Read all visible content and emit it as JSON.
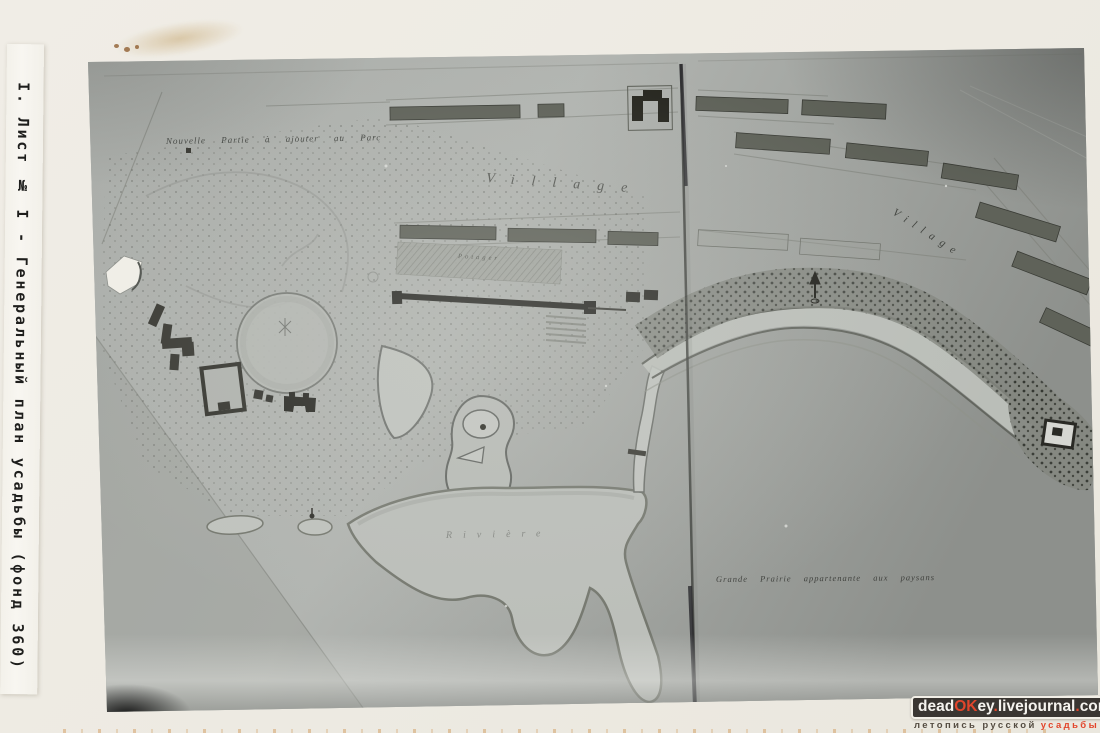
{
  "page": {
    "description": "Archival album page with a black-and-white photograph of an estate general plan",
    "paper_color": "#edeae2",
    "accent_red": "#e2452b"
  },
  "side_label": {
    "text": "I. Лист № I - Генеральный план усадьбы (фонд 360)"
  },
  "photo": {
    "map_labels": {
      "nouvelle_partie": "Nouvelle Partie à ajouter au Parc",
      "village_top": "Village",
      "village_right": "Village",
      "potager": "Potager",
      "riviere": "Rivière",
      "grande_prairie": "Grande Prairie appartenante aux paysans"
    }
  },
  "watermark": {
    "site": "deadOKey.livejournal.com",
    "site_segments": [
      {
        "text": "dead",
        "color": "#f5f3ee"
      },
      {
        "text": "OK",
        "color": "#e2452b"
      },
      {
        "text": "ey",
        "color": "#f5f3ee"
      },
      {
        "text": ".",
        "color": "#e2452b"
      },
      {
        "text": "livejournal",
        "color": "#f5f3ee"
      },
      {
        "text": ".",
        "color": "#e2452b"
      },
      {
        "text": "com",
        "color": "#f5f3ee"
      }
    ],
    "tagline_segments": [
      {
        "text": "летопись русской",
        "color": "#554d42"
      },
      {
        "text": "усадьбы",
        "color": "#e2452b"
      }
    ],
    "badge_background": "#3a3632",
    "badge_border": "#f2efe7"
  }
}
